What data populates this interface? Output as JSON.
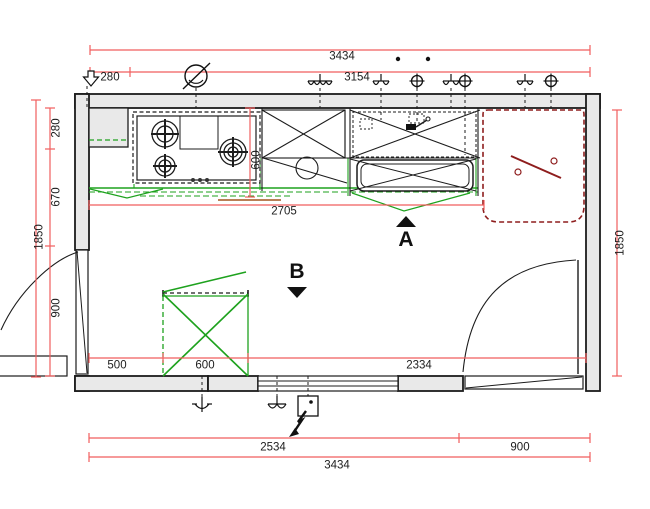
{
  "plan": {
    "title": "Kitchen floor plan",
    "colors": {
      "dimension_red": "#f15e5e",
      "annotation_green": "#1ea21e",
      "fixture_dark_red": "#8e1d1d",
      "wall_fill": "#e9e9e9",
      "ink": "#1c1c1c",
      "accent_brown": "#a2551f"
    },
    "dims": {
      "top_total": "3434",
      "top_offset": "280",
      "top_run": "3154",
      "counter_length": "2705",
      "counter_depth": "600",
      "left_upper": "280",
      "left_mid": "670",
      "left_lower": "900",
      "left_total": "1850",
      "right_total": "1850",
      "floor_left": "500",
      "floor_island": "600",
      "floor_right": "2334",
      "bottom_run": "2534",
      "bottom_door": "900",
      "bottom_total": "3434"
    },
    "markers": {
      "a": "A",
      "b": "B"
    },
    "icons": {
      "entry-arrow-icon": "outlined down arrow",
      "ceiling-light-icon": "circle with slash",
      "multi-socket-icon": "bar with four hooks",
      "wall-lamp-icon": "bar with two hooks",
      "socket-icon": "circled cross",
      "pendant-lamp-icon": "stem with cup",
      "switch-box-icon": "box with dot",
      "power-bolt-icon": "lightning arrow"
    }
  }
}
